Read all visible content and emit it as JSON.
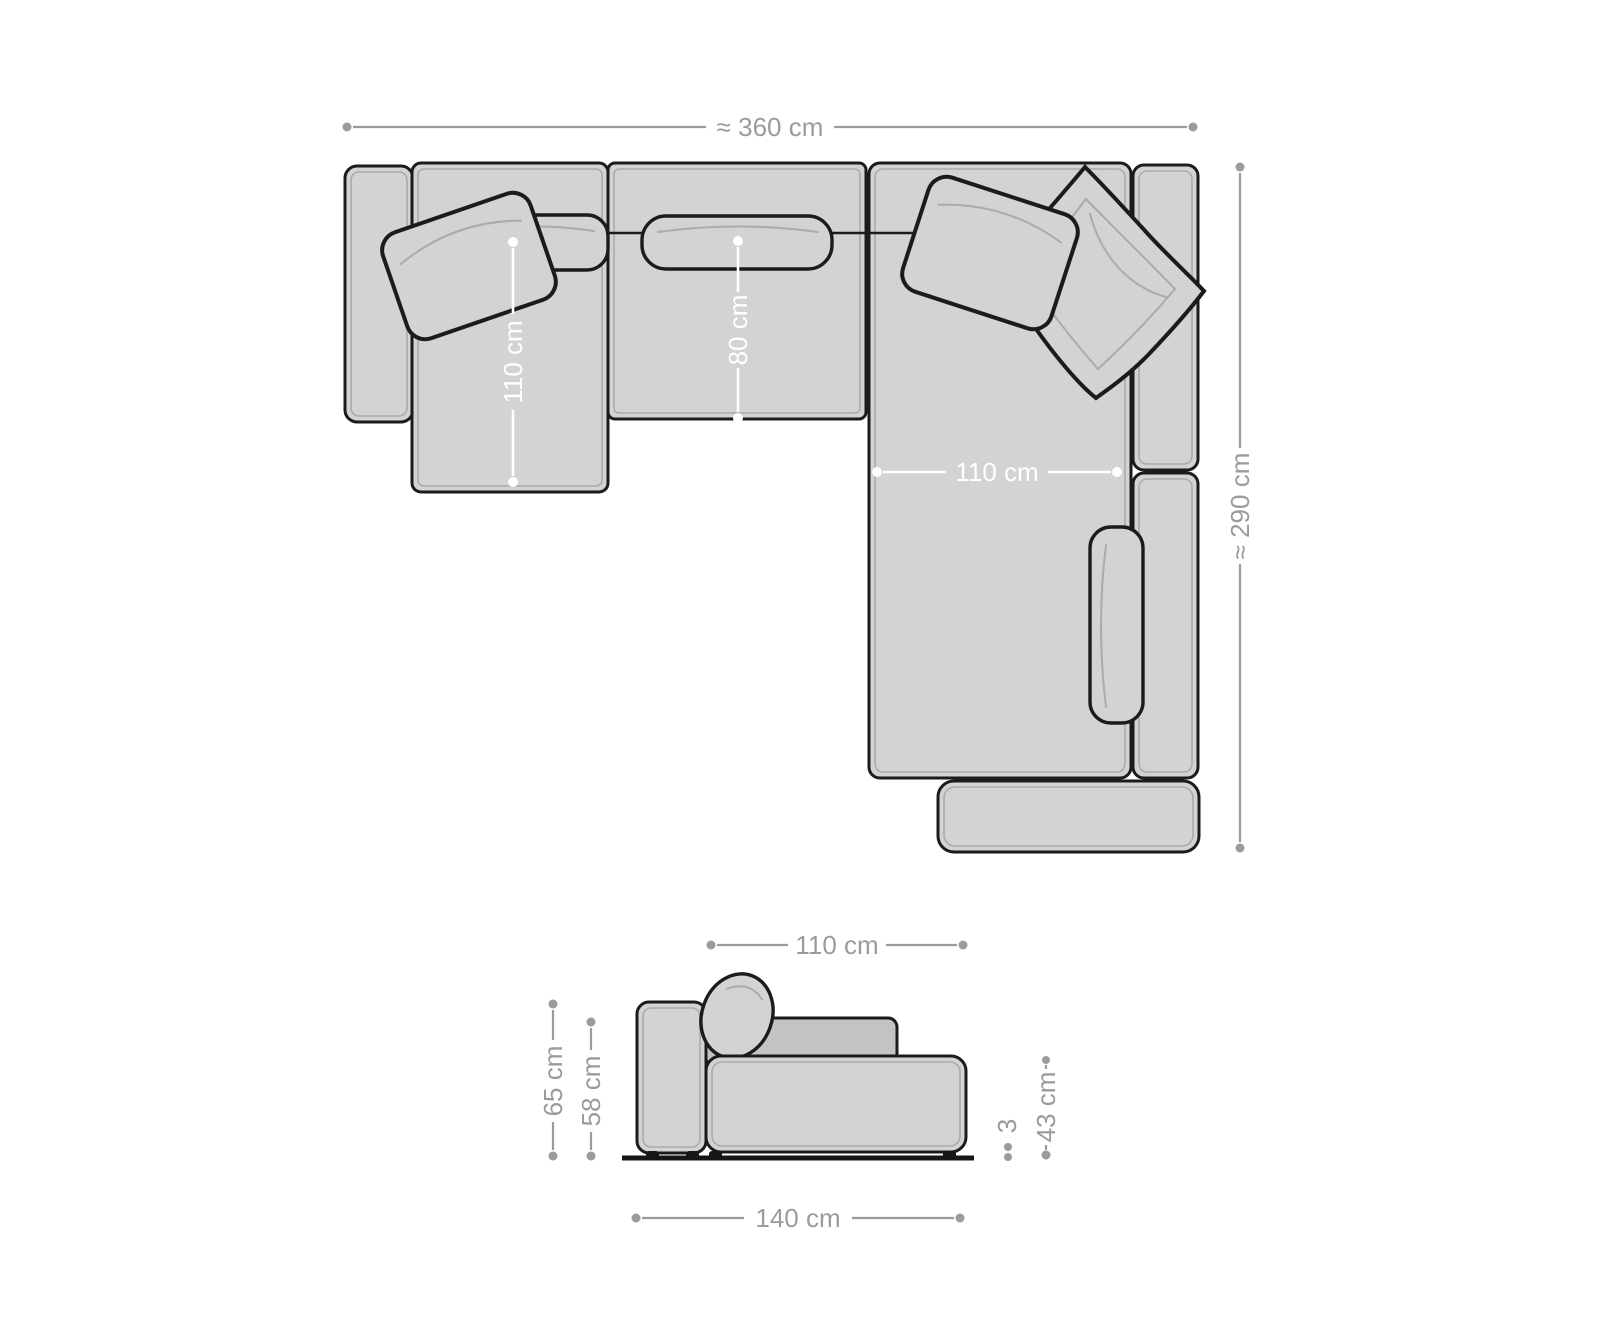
{
  "top_view": {
    "overall_width": "≈ 360 cm",
    "overall_depth": "≈ 290 cm",
    "left_chaise_depth": "110 cm",
    "middle_seat_depth": "80 cm",
    "right_chaise_width": "110 cm"
  },
  "side_view": {
    "seat_depth": "110 cm",
    "total_depth": "140 cm",
    "armrest_height": "65 cm",
    "backrest_height": "58 cm",
    "seat_height": "43 cm",
    "foot_height": "3"
  },
  "colors": {
    "background": "#ffffff",
    "outline": "#1b1b1b",
    "upholstery": "#d3d3d4",
    "upholstery_dark": "#c3c3c4",
    "inner_line": "#ababab",
    "dimension": "#9b9b9b",
    "dimension_on_fabric": "#ffffff"
  }
}
